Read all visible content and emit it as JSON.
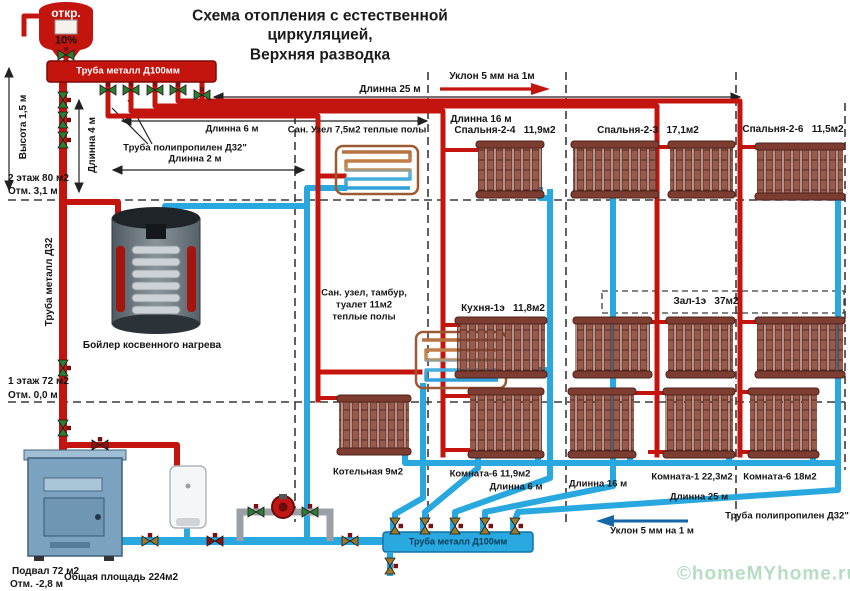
{
  "title": {
    "line1": "Схема отопления с естественной",
    "line2": "циркуляцией,",
    "line3": "Верхняя разводка"
  },
  "expansion_tank": {
    "open_label": "откр.",
    "percent": "10%"
  },
  "top_manifold": {
    "label": "Труба металл Д100мм"
  },
  "bottom_manifold": {
    "label": "Труба металл Д100мм"
  },
  "left_annotations": {
    "height": "Высота 1,5 м",
    "floor2_area": "2 этаж 80 м2",
    "floor2_elev": "Отм. 3,1 м",
    "length4": "Длинна 4 м",
    "riser_pipe": "Труба металл Д32",
    "floor1_area": "1 этаж 72 м2",
    "floor1_elev": "Отм. 0,0 м",
    "basement_area": "Подвал 72 м2",
    "basement_elev": "Отм. -2,8 м",
    "total_area": "Общая площадь 224м2"
  },
  "top_annotations": {
    "len6": "Длинна 6 м",
    "poly_pipe": "Труба полипропилен Д32\"",
    "len2": "Длинна 2 м",
    "len25": "Длинна 25 м",
    "slope": "Уклон 5 мм на 1м",
    "len16": "Длинна 16 м"
  },
  "equipment": {
    "indirect_boiler": "Бойлер косвенного нагрева"
  },
  "rooms": {
    "san_uzel2": "Сан. Узел 7,5м2 теплые полы",
    "bedroom24": "Спальня-2-4   11,9м2",
    "bedroom23": "Спальня-2-3   17,1м2",
    "bedroom26": "Спальня-2-6   11,5м2",
    "san_uzel1_l1": "Сан. узел, тамбур,",
    "san_uzel1_l2": "туалет 11м2",
    "san_uzel1_l3": "теплые полы",
    "kitchen": "Кухня-1э   11,8м2",
    "hall": "Зал-1э   37м2",
    "boiler_room": "Котельная 9м2",
    "room6a": "Комната-6 11,9м2",
    "room1": "Комната-1 22,3м2",
    "room6b": "Комната-6 18м2"
  },
  "bottom_annotations": {
    "len6": "Длинна 6 м",
    "len16": "Длинна 16 м",
    "len25": "Длинна 25 м",
    "poly_pipe": "Труба полипропилен Д32\"",
    "slope": "Уклон 5 мм на 1 м"
  },
  "watermark": "©homeMYhome.ru",
  "colors": {
    "supply": "#c3140e",
    "return": "#29a8e0"
  }
}
